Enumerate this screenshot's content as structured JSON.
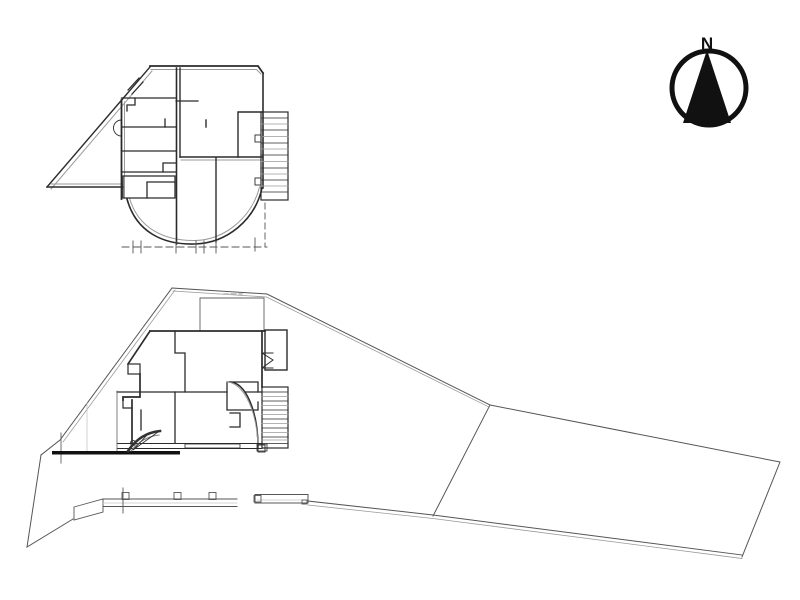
{
  "document": {
    "kind": "architectural line drawing",
    "background": "#ffffff"
  },
  "palette": {
    "line_dark": "#2b2b2b",
    "line_medium": "#606060",
    "line_light": "#9a9a9a",
    "fill_black": "#111111"
  },
  "north_arrow": {
    "label": "N"
  },
  "plans": {
    "upper_plan": {
      "label": ""
    },
    "site_plan": {
      "label": ""
    }
  }
}
